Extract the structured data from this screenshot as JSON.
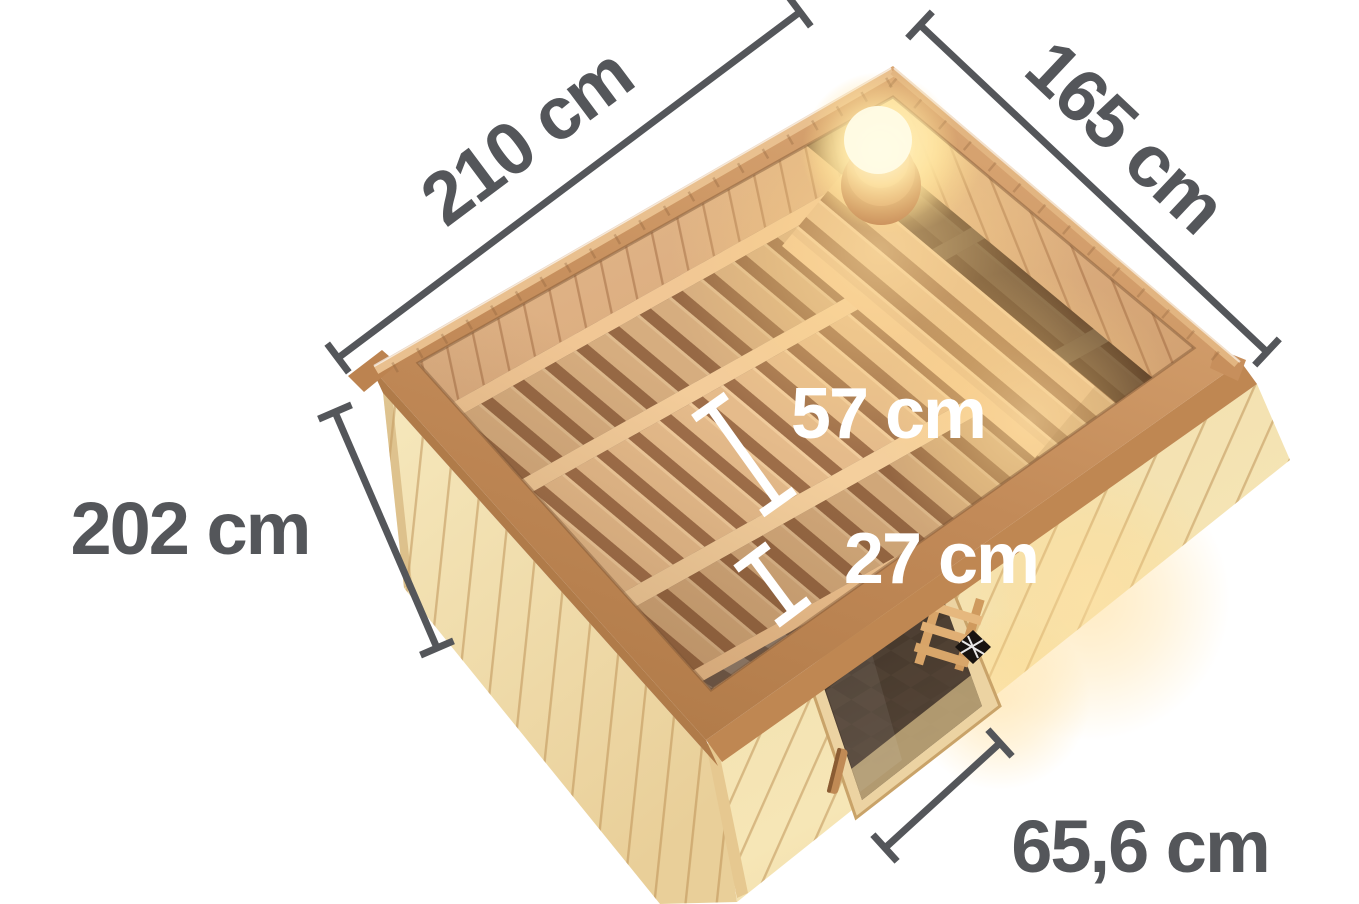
{
  "diagram": {
    "title": "Sauna top-view dimension diagram",
    "measurements": {
      "outer_width": {
        "label": "210 cm",
        "value": 210,
        "unit": "cm"
      },
      "outer_depth": {
        "label": "165 cm",
        "value": 165,
        "unit": "cm"
      },
      "wall_height": {
        "label": "202 cm",
        "value": 202,
        "unit": "cm"
      },
      "bench_depth": {
        "label": "57 cm",
        "value": 57,
        "unit": "cm"
      },
      "step_depth": {
        "label": "27 cm",
        "value": 27,
        "unit": "cm"
      },
      "door_width": {
        "label": "65,6 cm",
        "value": 65.6,
        "unit": "cm"
      }
    },
    "colors": {
      "background": "#ffffff",
      "dimension_gray": "#54565a",
      "dimension_white": "#ffffff",
      "wood_rim": "#c79061",
      "wood_rim_back": "#d9a877",
      "wood_wall_exterior": "#f2e0ae",
      "wood_interior_wall": "#ddae7f",
      "bench_slat": "#e5bb8b",
      "bench_gap": "#9e6e49",
      "floor_tile_light": "#8f7d6c",
      "floor_tile_dark": "#6c594a",
      "door_glass": "#3a2e25",
      "lamp_glow": "#ffd98a"
    }
  }
}
